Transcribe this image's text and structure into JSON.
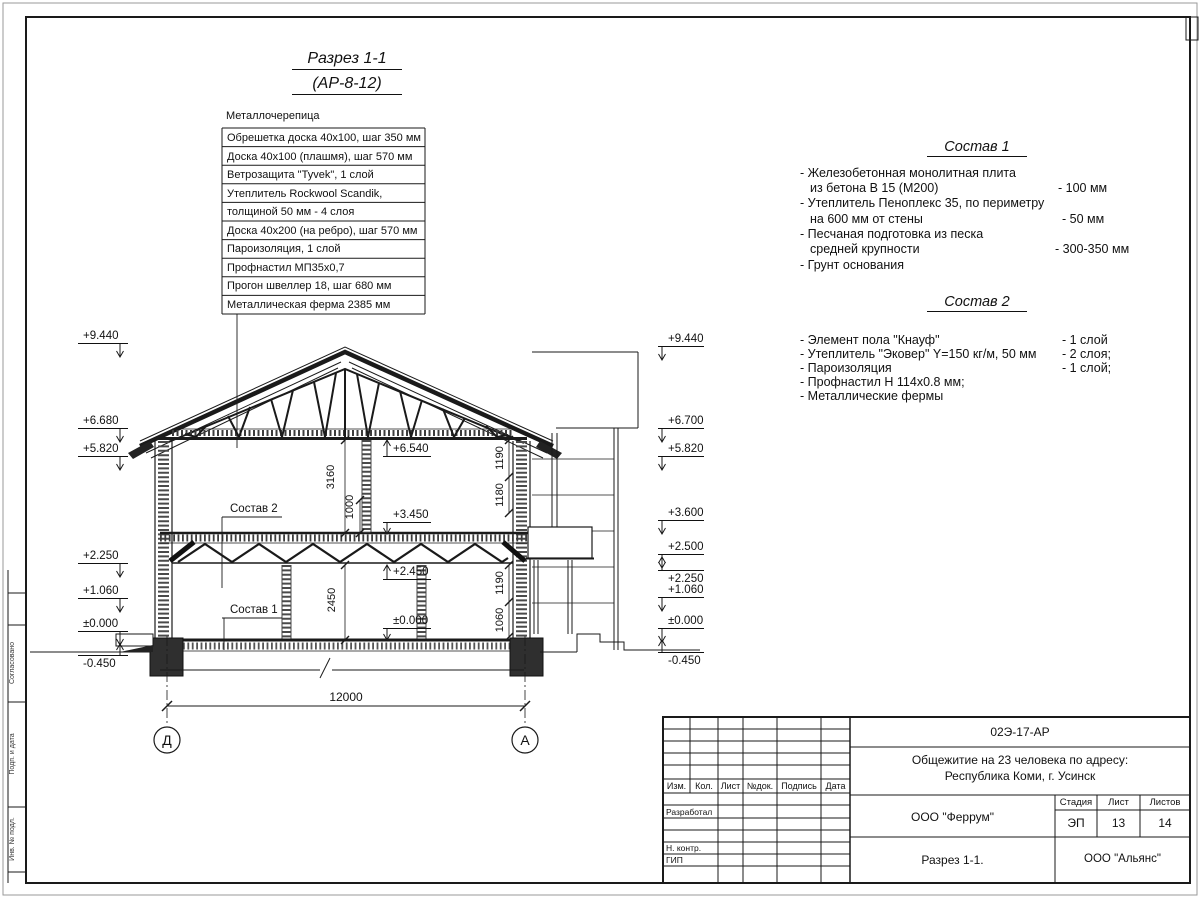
{
  "title": {
    "line1": "Разрез 1-1",
    "line2": "(АР-8-12)"
  },
  "callout": {
    "header": "Металлочерепица",
    "rows": [
      "Обрешетка доска 40х100, шаг 350 мм",
      "Доска 40х100 (плашмя), шаг 570 мм",
      "Ветрозащита \"Tyvek\", 1 слой",
      "Утеплитель Rockwool Scandik,",
      "толщиной 50 мм - 4 слоя",
      "Доска 40х200 (на ребро), шаг 570 мм",
      "Пароизоляция, 1 слой",
      "Профнастил МП35х0,7",
      "Прогон швеллер 18, шаг 680 мм",
      "Металлическая ферма 2385 мм"
    ]
  },
  "sostav1": {
    "heading": "Состав 1",
    "lines": [
      {
        "t": "- Железобетонная  монолитная плита",
        "v": ""
      },
      {
        "t": "из бетона В 15 (М200)",
        "v": "- 100 мм"
      },
      {
        "t": "- Утеплитель Пеноплекс 35, по периметру",
        "v": ""
      },
      {
        "t": "на 600 мм от стены",
        "v": "- 50 мм"
      },
      {
        "t": "- Песчаная подготовка из песка",
        "v": ""
      },
      {
        "t": "средней крупности",
        "v": "- 300-350 мм"
      },
      {
        "t": "- Грунт основания",
        "v": ""
      }
    ]
  },
  "sostav2": {
    "heading": "Состав 2",
    "lines": [
      {
        "t": "- Элемент пола \"Кнауф\"",
        "v": "- 1 слой"
      },
      {
        "t": "- Утеплитель \"Эковер\" Y=150 кг/м, 50 мм",
        "v": "- 2 слоя;"
      },
      {
        "t": "- Пароизоляция",
        "v": "- 1 слой;"
      },
      {
        "t": "- Профнастил Н 114х0.8 мм;",
        "v": ""
      },
      {
        "t": "- Металлические фермы",
        "v": ""
      }
    ]
  },
  "marks": {
    "left": [
      "+9.440",
      "+6.680",
      "+5.820",
      "+2.250",
      "+1.060",
      "±0.000",
      "-0.450"
    ],
    "right": [
      "+9.440",
      "+6.700",
      "+5.820",
      "+3.600",
      "+2.500",
      "+2.250",
      "+1.060",
      "±0.000",
      "-0.450"
    ],
    "inner": [
      "+6.540",
      "+3.450",
      "+2.450",
      "±0.000"
    ]
  },
  "dims": {
    "span": "12000",
    "v3160": "3160",
    "v1000": "1000",
    "v2450": "2450",
    "r1": "1190",
    "r2": "1180",
    "r3": "1190",
    "r4": "1060"
  },
  "axes": {
    "left": "Д",
    "right": "А"
  },
  "refs": {
    "sostav2": "Состав 2",
    "sostav1": "Состав 1"
  },
  "frame": {
    "s1": "Согласовано",
    "s2": "Подп. и дата",
    "s3": "Инв. № подл."
  },
  "stamp": {
    "code": "02Э-17-АР",
    "project1": "Общежитие на 23 человека по адресу:",
    "project2": "Республика Коми, г. Усинск",
    "org": "ООО \"Феррум\"",
    "stage_label": "Стадия",
    "sheet_label": "Лист",
    "sheets_label": "Листов",
    "stage": "ЭП",
    "sheet": "13",
    "sheets": "14",
    "drawing": "Разрез 1-1.",
    "contractor": "ООО \"Альянс\"",
    "h_izm": "Изм.",
    "h_kol": "Кол.",
    "h_list": "Лист",
    "h_doc": "№док.",
    "h_sign": "Подпись",
    "h_date": "Дата",
    "r_dev": "Разработал",
    "r_ncontr": "Н. контр.",
    "r_gip": "ГИП"
  }
}
